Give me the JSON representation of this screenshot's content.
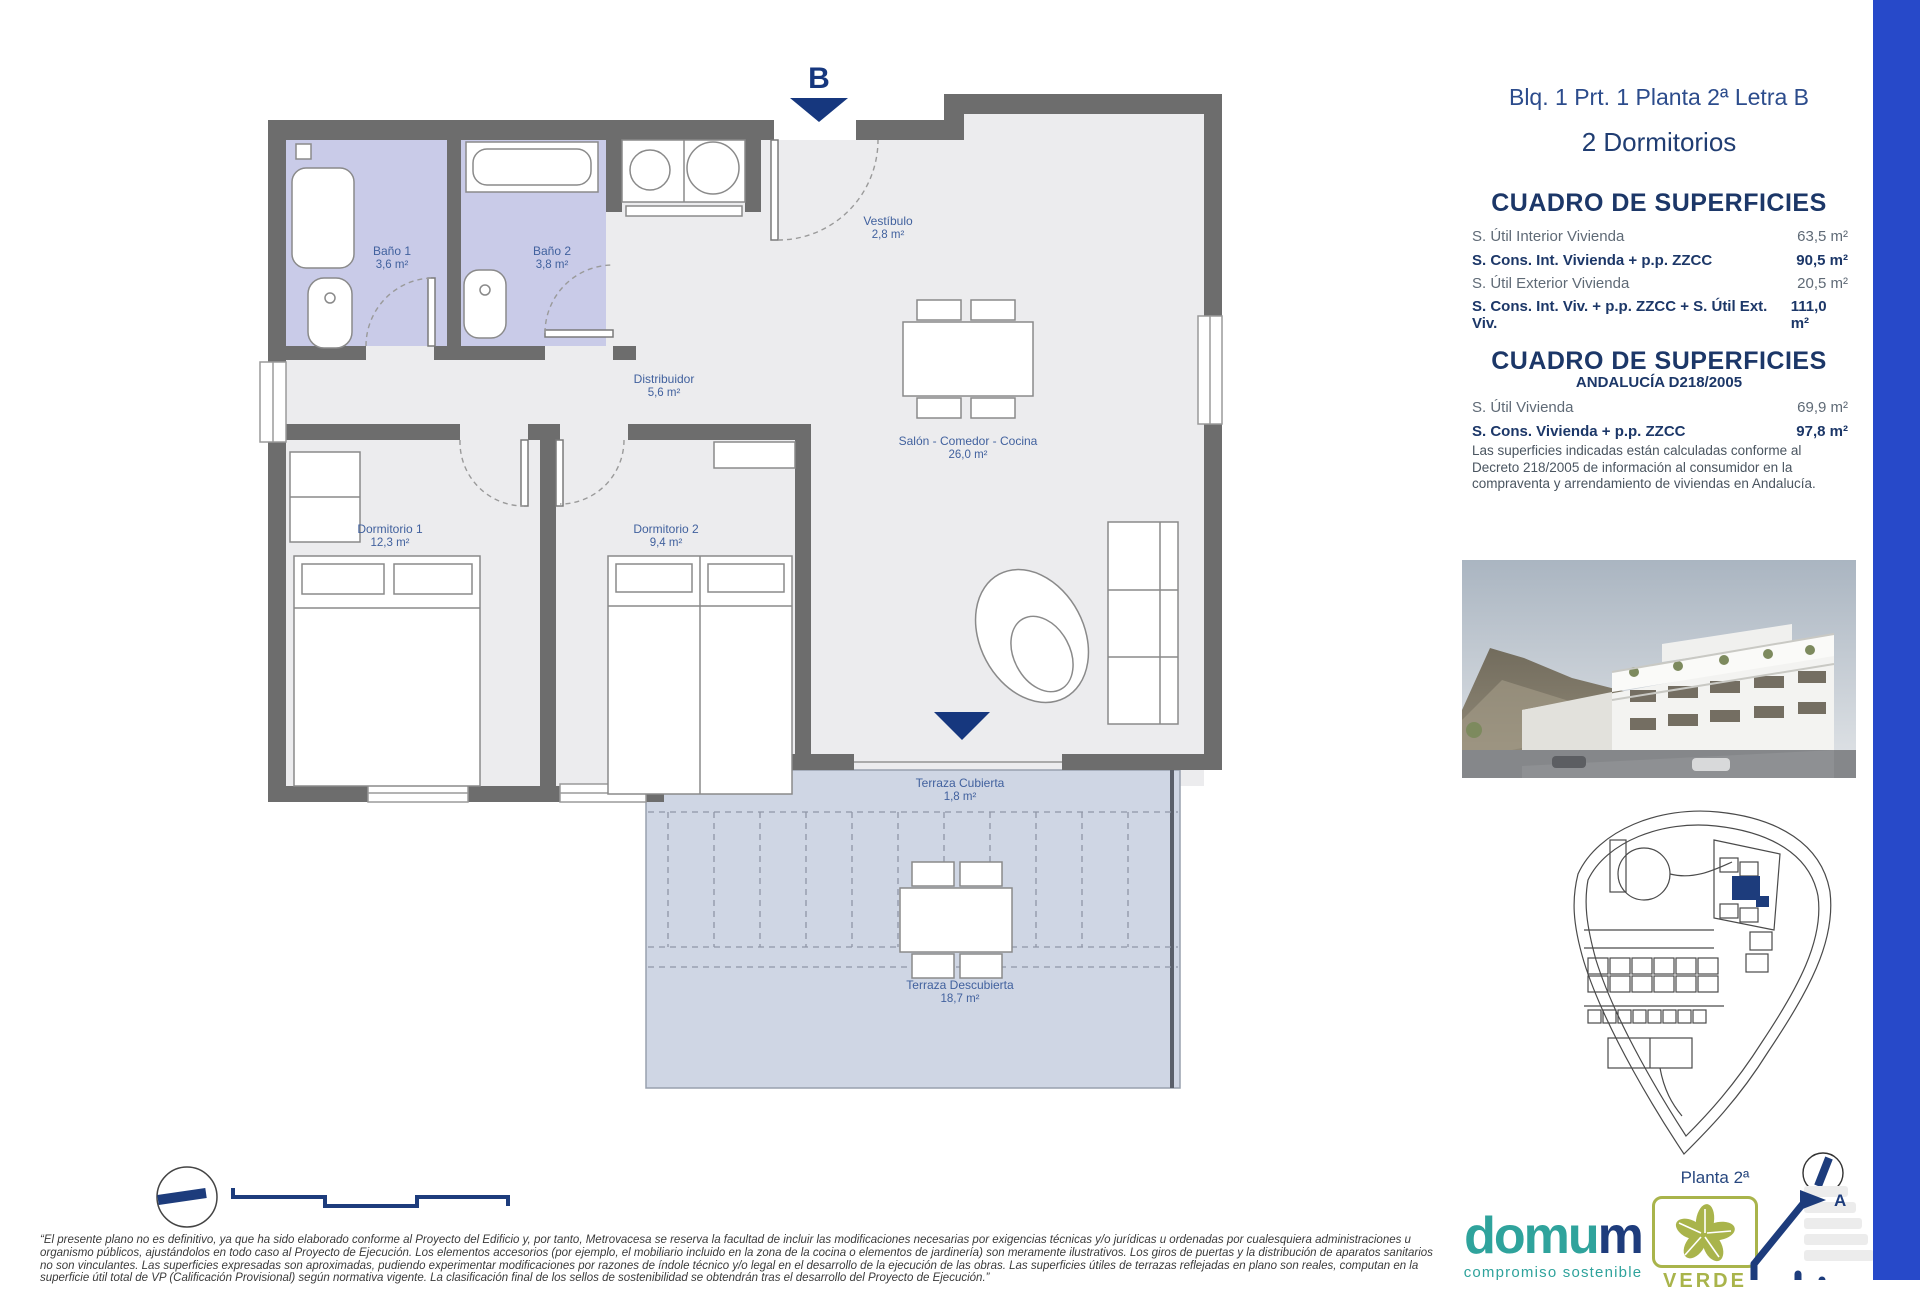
{
  "page": {
    "accent_bar_color": "#2749c9"
  },
  "plan": {
    "entrance_marker": "B",
    "rooms": [
      {
        "name": "Baño 1",
        "area": "3,6 m²"
      },
      {
        "name": "Baño 2",
        "area": "3,8 m²"
      },
      {
        "name": "Vestíbulo",
        "area": "2,8 m²"
      },
      {
        "name": "Distribuidor",
        "area": "5,6 m²"
      },
      {
        "name": "Salón - Comedor - Cocina",
        "area": "26,0 m²"
      },
      {
        "name": "Dormitorio 1",
        "area": "12,3 m²"
      },
      {
        "name": "Dormitorio 2",
        "area": "9,4 m²"
      },
      {
        "name": "Terraza Cubierta",
        "area": "1,8 m²"
      },
      {
        "name": "Terraza Descubierta",
        "area": "18,7 m²"
      }
    ]
  },
  "sidebar": {
    "title": "Blq. 1 Prt. 1 Planta 2ª Letra B",
    "subtitle": "2 Dormitorios",
    "table1": {
      "heading": "CUADRO DE SUPERFICIES",
      "rows": [
        {
          "label": "S. Útil Interior Vivienda",
          "value": "63,5 m²"
        },
        {
          "label": "S. Cons. Int. Vivienda + p.p. ZZCC",
          "value": "90,5 m²"
        },
        {
          "label": "S. Útil Exterior Vivienda",
          "value": "20,5 m²"
        },
        {
          "label": "S. Cons. Int. Viv. + p.p. ZZCC + S. Útil Ext. Viv.",
          "value": "111,0 m²"
        }
      ]
    },
    "table2": {
      "heading": "CUADRO DE SUPERFICIES",
      "subheading": "ANDALUCÍA D218/2005",
      "rows": [
        {
          "label": "S. Útil Vivienda",
          "value": "69,9 m²"
        },
        {
          "label": "S. Cons. Vivienda + p.p. ZZCC",
          "value": "97,8 m²"
        }
      ],
      "note": "Las superficies indicadas están calculadas conforme al Decreto 218/2005 de información al consumidor en la compraventa y arrendamiento de viviendas en Andalucía."
    },
    "floor_label": "Planta 2ª",
    "energy_rating_letter": "A"
  },
  "footer": {
    "disclaimer": "“El presente plano no es definitivo, ya que ha sido elaborado conforme al Proyecto del Edificio y, por tanto, Metrovacesa se reserva la facultad de incluir las modificaciones necesarias por exigencias técnicas y/o jurídicas u ordenadas por cualesquiera administraciones u organismo públicos, ajustándolos en todo caso al Proyecto de Ejecución. Los elementos accesorios (por ejemplo, el mobiliario incluido en la zona de la cocina o elementos de jardinería) son meramente ilustrativos. Los giros de puertas y la distribución de aparatos sanitarios no son vinculantes. Las superficies expresadas son aproximadas, pudiendo experimentar modificaciones por razones de índole técnico y/o legal en el desarrollo de la ejecución de las obras. Las superficies útiles de terrazas reflejadas en plano son reales, computan en la superficie útil total de VP (Calificación Provisional) según normativa vigente. La clasificación final de los sellos de sostenibilidad se obtendrán tras el desarrollo del Proyecto de Ejecución.”",
    "domum_logo_part1": "domu",
    "domum_logo_part2": "m",
    "domum_tagline": "compromiso sostenible",
    "verde_label": "VERDE"
  }
}
